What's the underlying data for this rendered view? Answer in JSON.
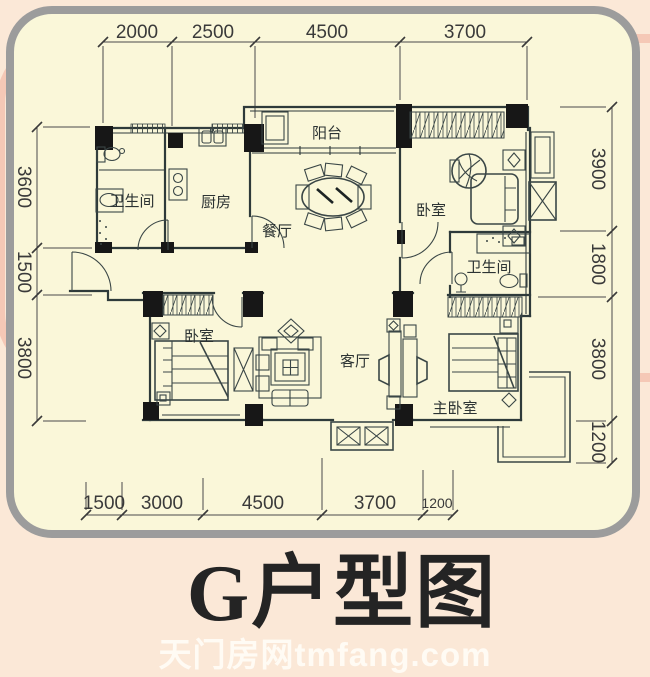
{
  "page": {
    "bg_color": "#fbe8d7",
    "panel_bg_color": "#faf7d9",
    "panel_border_color": "#9c9c9c",
    "pink_accent_color": "#f3c2b0",
    "wall_line_color": "#2e3a3a",
    "dim_text_color": "#3a3a3a",
    "title_color": "#242424",
    "watermark_color": "rgba(255,252,246,0.92)"
  },
  "title": "G户型图",
  "watermark": "天门房网tmfang.com",
  "rooms": {
    "bathroom_left": "卫生间",
    "kitchen": "厨房",
    "balcony": "阳台",
    "dining": "餐厅",
    "bedroom_top_right": "卧室",
    "bathroom_right": "卫生间",
    "bedroom_bottom_left": "卧室",
    "living": "客厅",
    "master_bedroom": "主卧室"
  },
  "dimensions": {
    "top": {
      "d1": "2000",
      "d2": "2500",
      "d3": "4500",
      "d4": "3700"
    },
    "bottom": {
      "d1": "1500",
      "d2": "3000",
      "d3": "4500",
      "d4": "3700",
      "d5": "1200"
    },
    "left": {
      "d1": "3600",
      "d2": "1500",
      "d3": "3800"
    },
    "right": {
      "d1": "3900",
      "d2": "1800",
      "d3": "3800",
      "d4": "1200"
    }
  }
}
